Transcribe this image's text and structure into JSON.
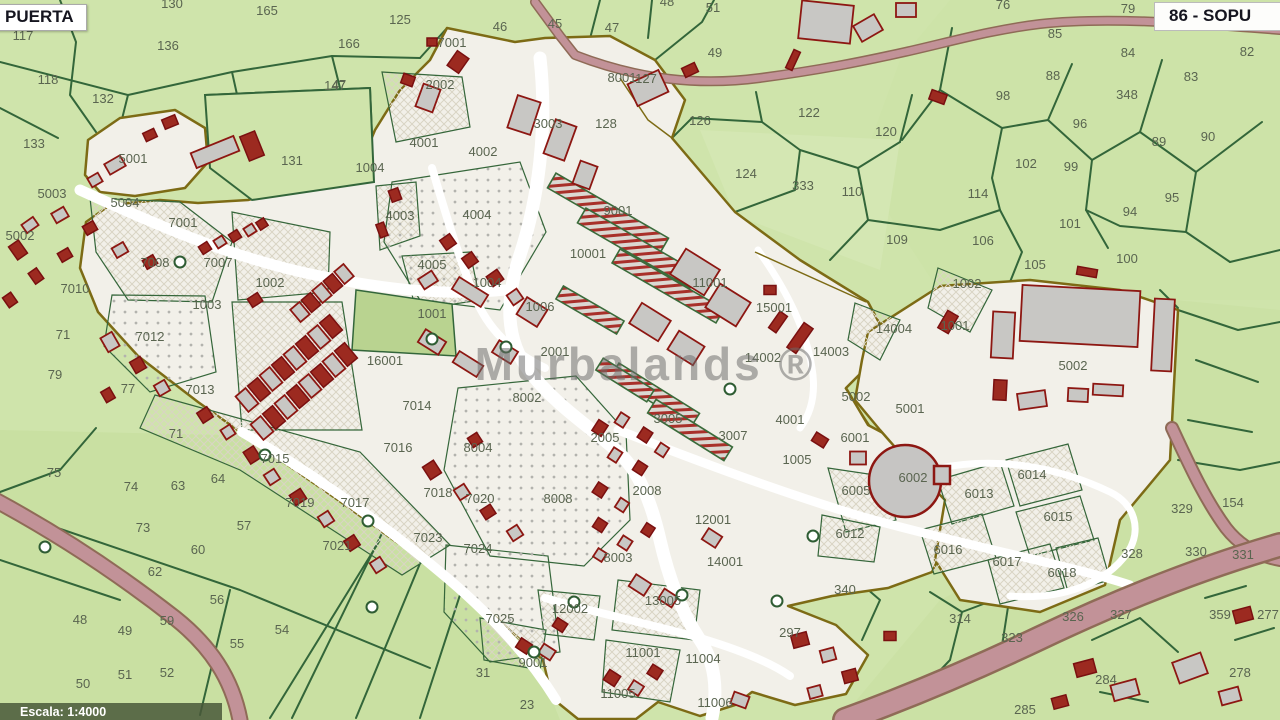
{
  "header": {
    "left_sheet_label": "PUERTA",
    "right_sheet_label": "86 - SOPU"
  },
  "footer": {
    "scale_label": "Escala: 1:4000"
  },
  "watermark": "Murbalands ®",
  "colors": {
    "parcel_green": "#cfe4ab",
    "boundary_green": "#33663a",
    "urban_fill": "#f2f0e9",
    "urban_border": "#7d6b15",
    "building_fill": "#c8c7c4",
    "building_outline": "#8d1712",
    "road_pink": "#c29298",
    "label_color": "#5a6550"
  },
  "map_labels": {
    "parcels": [
      {
        "t": "130",
        "x": 172,
        "y": 8
      },
      {
        "t": "117",
        "x": 23,
        "y": 40
      },
      {
        "t": "165",
        "x": 267,
        "y": 15
      },
      {
        "t": "166",
        "x": 349,
        "y": 48
      },
      {
        "t": "125",
        "x": 400,
        "y": 24
      },
      {
        "t": "147",
        "x": 335,
        "y": 90
      },
      {
        "t": "136",
        "x": 168,
        "y": 50
      },
      {
        "t": "118",
        "x": 48,
        "y": 84
      },
      {
        "t": "132",
        "x": 103,
        "y": 103
      },
      {
        "t": "133",
        "x": 34,
        "y": 148
      },
      {
        "t": "131",
        "x": 292,
        "y": 165
      },
      {
        "t": "47",
        "x": 339,
        "y": 89
      },
      {
        "t": "46",
        "x": 500,
        "y": 31
      },
      {
        "t": "45",
        "x": 555,
        "y": 28
      },
      {
        "t": "47",
        "x": 612,
        "y": 32
      },
      {
        "t": "48",
        "x": 667,
        "y": 6
      },
      {
        "t": "51",
        "x": 713,
        "y": 12
      },
      {
        "t": "49",
        "x": 715,
        "y": 57
      },
      {
        "t": "127",
        "x": 646,
        "y": 83
      },
      {
        "t": "128",
        "x": 606,
        "y": 128
      },
      {
        "t": "126",
        "x": 700,
        "y": 125
      },
      {
        "t": "122",
        "x": 809,
        "y": 117
      },
      {
        "t": "120",
        "x": 886,
        "y": 136
      },
      {
        "t": "124",
        "x": 746,
        "y": 178
      },
      {
        "t": "333",
        "x": 803,
        "y": 190
      },
      {
        "t": "110",
        "x": 852,
        "y": 196
      },
      {
        "t": "109",
        "x": 897,
        "y": 244
      },
      {
        "t": "76",
        "x": 1003,
        "y": 9
      },
      {
        "t": "79",
        "x": 1128,
        "y": 13
      },
      {
        "t": "85",
        "x": 1055,
        "y": 38
      },
      {
        "t": "84",
        "x": 1128,
        "y": 57
      },
      {
        "t": "82",
        "x": 1247,
        "y": 56
      },
      {
        "t": "83",
        "x": 1191,
        "y": 81
      },
      {
        "t": "88",
        "x": 1053,
        "y": 80
      },
      {
        "t": "348",
        "x": 1127,
        "y": 99
      },
      {
        "t": "98",
        "x": 1003,
        "y": 100
      },
      {
        "t": "96",
        "x": 1080,
        "y": 128
      },
      {
        "t": "90",
        "x": 1208,
        "y": 141
      },
      {
        "t": "89",
        "x": 1159,
        "y": 146
      },
      {
        "t": "102",
        "x": 1026,
        "y": 168
      },
      {
        "t": "99",
        "x": 1071,
        "y": 171
      },
      {
        "t": "114",
        "x": 978,
        "y": 198
      },
      {
        "t": "95",
        "x": 1172,
        "y": 202
      },
      {
        "t": "94",
        "x": 1130,
        "y": 216
      },
      {
        "t": "101",
        "x": 1070,
        "y": 228
      },
      {
        "t": "106",
        "x": 983,
        "y": 245
      },
      {
        "t": "105",
        "x": 1035,
        "y": 269
      },
      {
        "t": "100",
        "x": 1127,
        "y": 263
      },
      {
        "t": "79",
        "x": 55,
        "y": 379
      },
      {
        "t": "77",
        "x": 128,
        "y": 393
      },
      {
        "t": "71",
        "x": 63,
        "y": 339
      },
      {
        "t": "75",
        "x": 54,
        "y": 477
      },
      {
        "t": "71",
        "x": 176,
        "y": 438
      },
      {
        "t": "74",
        "x": 131,
        "y": 491
      },
      {
        "t": "63",
        "x": 178,
        "y": 490
      },
      {
        "t": "64",
        "x": 218,
        "y": 483
      },
      {
        "t": "73",
        "x": 143,
        "y": 532
      },
      {
        "t": "57",
        "x": 244,
        "y": 530
      },
      {
        "t": "60",
        "x": 198,
        "y": 554
      },
      {
        "t": "62",
        "x": 155,
        "y": 576
      },
      {
        "t": "56",
        "x": 217,
        "y": 604
      },
      {
        "t": "59",
        "x": 167,
        "y": 625
      },
      {
        "t": "48",
        "x": 80,
        "y": 624
      },
      {
        "t": "49",
        "x": 125,
        "y": 635
      },
      {
        "t": "54",
        "x": 282,
        "y": 634
      },
      {
        "t": "55",
        "x": 237,
        "y": 648
      },
      {
        "t": "51",
        "x": 125,
        "y": 679
      },
      {
        "t": "52",
        "x": 167,
        "y": 677
      },
      {
        "t": "50",
        "x": 83,
        "y": 688
      },
      {
        "t": "31",
        "x": 483,
        "y": 677
      },
      {
        "t": "23",
        "x": 527,
        "y": 709
      },
      {
        "t": "340",
        "x": 845,
        "y": 594
      },
      {
        "t": "297",
        "x": 790,
        "y": 637
      },
      {
        "t": "314",
        "x": 960,
        "y": 623
      },
      {
        "t": "323",
        "x": 1012,
        "y": 642
      },
      {
        "t": "326",
        "x": 1073,
        "y": 621
      },
      {
        "t": "327",
        "x": 1121,
        "y": 619
      },
      {
        "t": "328",
        "x": 1132,
        "y": 558
      },
      {
        "t": "329",
        "x": 1182,
        "y": 513
      },
      {
        "t": "330",
        "x": 1196,
        "y": 556
      },
      {
        "t": "331",
        "x": 1243,
        "y": 559
      },
      {
        "t": "154",
        "x": 1233,
        "y": 507
      },
      {
        "t": "359",
        "x": 1220,
        "y": 619
      },
      {
        "t": "277",
        "x": 1268,
        "y": 619
      },
      {
        "t": "284",
        "x": 1106,
        "y": 684
      },
      {
        "t": "278",
        "x": 1240,
        "y": 677
      },
      {
        "t": "285",
        "x": 1025,
        "y": 714
      },
      {
        "t": "5001",
        "x": 133,
        "y": 163
      },
      {
        "t": "5003",
        "x": 52,
        "y": 198
      },
      {
        "t": "5004",
        "x": 125,
        "y": 207
      },
      {
        "t": "5002",
        "x": 20,
        "y": 240
      },
      {
        "t": "7001",
        "x": 183,
        "y": 227
      },
      {
        "t": "7008",
        "x": 155,
        "y": 267
      },
      {
        "t": "7007",
        "x": 218,
        "y": 267
      },
      {
        "t": "7010",
        "x": 75,
        "y": 293
      },
      {
        "t": "1003",
        "x": 207,
        "y": 309
      },
      {
        "t": "1002",
        "x": 270,
        "y": 287
      },
      {
        "t": "7012",
        "x": 150,
        "y": 341
      },
      {
        "t": "7013",
        "x": 200,
        "y": 394
      },
      {
        "t": "7015",
        "x": 275,
        "y": 463
      },
      {
        "t": "7016",
        "x": 398,
        "y": 452
      },
      {
        "t": "7014",
        "x": 417,
        "y": 410
      },
      {
        "t": "7017",
        "x": 355,
        "y": 507
      },
      {
        "t": "7018",
        "x": 438,
        "y": 497
      },
      {
        "t": "7019",
        "x": 300,
        "y": 507
      },
      {
        "t": "7020",
        "x": 480,
        "y": 503
      },
      {
        "t": "7021",
        "x": 337,
        "y": 550
      },
      {
        "t": "7023",
        "x": 428,
        "y": 542
      },
      {
        "t": "7024",
        "x": 478,
        "y": 553
      },
      {
        "t": "7025",
        "x": 500,
        "y": 623
      },
      {
        "t": "8004",
        "x": 478,
        "y": 452
      },
      {
        "t": "8002",
        "x": 527,
        "y": 402
      },
      {
        "t": "8008",
        "x": 558,
        "y": 503
      },
      {
        "t": "8003",
        "x": 618,
        "y": 562
      },
      {
        "t": "2002",
        "x": 440,
        "y": 89
      },
      {
        "t": "8001",
        "x": 622,
        "y": 82
      },
      {
        "t": "3003",
        "x": 548,
        "y": 128
      },
      {
        "t": "7001",
        "x": 452,
        "y": 47
      },
      {
        "t": "4001",
        "x": 424,
        "y": 147
      },
      {
        "t": "4002",
        "x": 483,
        "y": 156
      },
      {
        "t": "1004",
        "x": 370,
        "y": 172
      },
      {
        "t": "4003",
        "x": 400,
        "y": 220
      },
      {
        "t": "4004",
        "x": 477,
        "y": 219
      },
      {
        "t": "4005",
        "x": 432,
        "y": 269
      },
      {
        "t": "1004",
        "x": 487,
        "y": 287
      },
      {
        "t": "1006",
        "x": 540,
        "y": 311
      },
      {
        "t": "1001",
        "x": 432,
        "y": 318
      },
      {
        "t": "16001",
        "x": 385,
        "y": 365
      },
      {
        "t": "2001",
        "x": 555,
        "y": 356
      },
      {
        "t": "10001",
        "x": 588,
        "y": 258
      },
      {
        "t": "9001",
        "x": 618,
        "y": 215
      },
      {
        "t": "11001",
        "x": 710,
        "y": 287
      },
      {
        "t": "15001",
        "x": 774,
        "y": 312
      },
      {
        "t": "14004",
        "x": 894,
        "y": 333
      },
      {
        "t": "14003",
        "x": 831,
        "y": 356
      },
      {
        "t": "14002",
        "x": 763,
        "y": 362
      },
      {
        "t": "3005",
        "x": 668,
        "y": 423
      },
      {
        "t": "2005",
        "x": 605,
        "y": 442
      },
      {
        "t": "3007",
        "x": 733,
        "y": 440
      },
      {
        "t": "2008",
        "x": 647,
        "y": 495
      },
      {
        "t": "12001",
        "x": 713,
        "y": 524
      },
      {
        "t": "14001",
        "x": 725,
        "y": 566
      },
      {
        "t": "1005",
        "x": 797,
        "y": 464
      },
      {
        "t": "4001",
        "x": 790,
        "y": 424
      },
      {
        "t": "6001",
        "x": 855,
        "y": 442
      },
      {
        "t": "6005",
        "x": 856,
        "y": 495
      },
      {
        "t": "6012",
        "x": 850,
        "y": 538
      },
      {
        "t": "6002",
        "x": 913,
        "y": 482
      },
      {
        "t": "5001",
        "x": 910,
        "y": 413
      },
      {
        "t": "5002",
        "x": 856,
        "y": 401
      },
      {
        "t": "5002",
        "x": 1073,
        "y": 370
      },
      {
        "t": "1002",
        "x": 967,
        "y": 288
      },
      {
        "t": "1001",
        "x": 955,
        "y": 330
      },
      {
        "t": "6013",
        "x": 979,
        "y": 498
      },
      {
        "t": "6014",
        "x": 1032,
        "y": 479
      },
      {
        "t": "6015",
        "x": 1058,
        "y": 521
      },
      {
        "t": "6016",
        "x": 948,
        "y": 554
      },
      {
        "t": "6017",
        "x": 1007,
        "y": 566
      },
      {
        "t": "6018",
        "x": 1062,
        "y": 577
      },
      {
        "t": "12002",
        "x": 570,
        "y": 613
      },
      {
        "t": "13005",
        "x": 663,
        "y": 605
      },
      {
        "t": "9001",
        "x": 533,
        "y": 667
      },
      {
        "t": "11001",
        "x": 643,
        "y": 657
      },
      {
        "t": "11004",
        "x": 703,
        "y": 663
      },
      {
        "t": "11005",
        "x": 618,
        "y": 698
      },
      {
        "t": "11006",
        "x": 715,
        "y": 707
      }
    ]
  }
}
